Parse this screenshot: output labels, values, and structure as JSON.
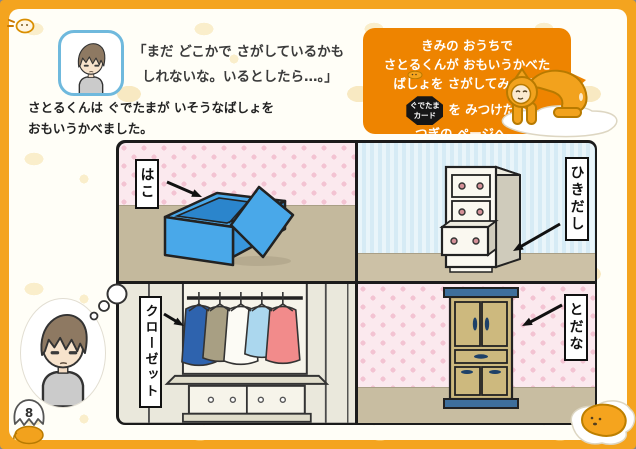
{
  "page": {
    "number": "8"
  },
  "colors": {
    "frame_orange": "#F4A41F",
    "callout_orange": "#EE8400",
    "box_blue": "#49A8E9",
    "wall_pink": "#FBE9EE",
    "wall_blue_stripe": "#D6EBF5",
    "floor_tan": "#C8BDA1",
    "cabinet_khaki": "#CDB97E",
    "cabinet_trim_blue": "#3E6F9C"
  },
  "header": {
    "speech": {
      "line1": "「まだ どこかで さがしているかも",
      "line2": "しれないな。いるとしたら…。」"
    },
    "narration": {
      "line1": "さとるくんは ぐでたまが いそうなばしょを",
      "line2": "おもいうかべました。"
    }
  },
  "callout": {
    "line1": "きみの おうちで",
    "line2": "さとるくんが おもいうかべた",
    "line3": "ばしょを さがしてみよう!",
    "badge": {
      "line1": "ぐでたま",
      "line2": "カード"
    },
    "line4": "を みつけたら",
    "line5": "つぎの ページへ。"
  },
  "panel": {
    "quadrants": [
      {
        "id": "box",
        "label": "はこ"
      },
      {
        "id": "drawers",
        "label": "ひきだし"
      },
      {
        "id": "closet",
        "label": "クローゼット"
      },
      {
        "id": "cupboard",
        "label": "とだな"
      }
    ]
  }
}
